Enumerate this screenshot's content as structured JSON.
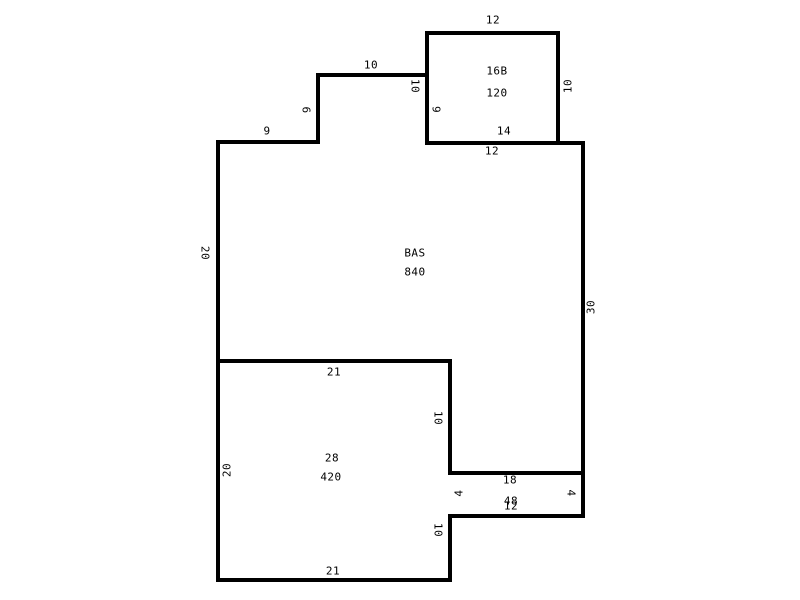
{
  "diagram": {
    "type": "floorplan-sketch",
    "background_color": "#ffffff",
    "wall_color": "#000000",
    "text_color": "#000000",
    "wall_thickness_px": 4,
    "rooms": [
      {
        "label": "16B",
        "area": "120",
        "dimensions": [
          "12",
          "10",
          "12",
          "10",
          "6"
        ]
      },
      {
        "label": "BAS",
        "area": "840",
        "dimensions": [
          "9",
          "6",
          "10",
          "14",
          "30",
          "20"
        ]
      },
      {
        "label": "28",
        "area": "420",
        "dimensions": [
          "21",
          "20",
          "10",
          "10",
          "21"
        ]
      },
      {
        "label": "18",
        "area": "48",
        "dimensions": [
          "4",
          "12",
          "4"
        ]
      }
    ],
    "walls": [
      {
        "name": "wall-16b-top",
        "o": "h",
        "x": 427,
        "y": 33,
        "len": 131
      },
      {
        "name": "wall-16b-left",
        "o": "v",
        "x": 427,
        "y": 33,
        "len": 110
      },
      {
        "name": "wall-16b-right",
        "o": "v",
        "x": 558,
        "y": 33,
        "len": 110
      },
      {
        "name": "wall-step-top",
        "o": "h",
        "x": 318,
        "y": 75,
        "len": 109
      },
      {
        "name": "wall-step-left",
        "o": "v",
        "x": 318,
        "y": 75,
        "len": 67
      },
      {
        "name": "wall-bas-top-left",
        "o": "h",
        "x": 218,
        "y": 142,
        "len": 100
      },
      {
        "name": "wall-bas-top-right",
        "o": "h",
        "x": 427,
        "y": 143,
        "len": 156
      },
      {
        "name": "wall-left-edge",
        "o": "v",
        "x": 218,
        "y": 142,
        "len": 438
      },
      {
        "name": "wall-right-edge",
        "o": "v",
        "x": 583,
        "y": 143,
        "len": 373
      },
      {
        "name": "wall-room28-top",
        "o": "h",
        "x": 218,
        "y": 361,
        "len": 232
      },
      {
        "name": "wall-room28-right-up",
        "o": "v",
        "x": 450,
        "y": 361,
        "len": 112
      },
      {
        "name": "wall-strip-top",
        "o": "h",
        "x": 450,
        "y": 473,
        "len": 133
      },
      {
        "name": "wall-strip-bottom",
        "o": "h",
        "x": 450,
        "y": 516,
        "len": 133
      },
      {
        "name": "wall-room28-right-low",
        "o": "v",
        "x": 450,
        "y": 516,
        "len": 64
      },
      {
        "name": "wall-room28-bottom",
        "o": "h",
        "x": 218,
        "y": 580,
        "len": 232
      }
    ],
    "texts": [
      {
        "name": "dim-16b-top",
        "t": "12",
        "x": 493,
        "y": 20,
        "r": 0
      },
      {
        "name": "room-16b-label",
        "t": "16B",
        "x": 497,
        "y": 71,
        "r": 0
      },
      {
        "name": "room-16b-area",
        "t": "120",
        "x": 497,
        "y": 93,
        "r": 0
      },
      {
        "name": "dim-16b-right",
        "t": "10",
        "x": 568,
        "y": 86,
        "r": -90
      },
      {
        "name": "dim-16b-left",
        "t": "10",
        "x": 415,
        "y": 86,
        "r": 90
      },
      {
        "name": "dim-16b-left-lower",
        "t": "6",
        "x": 437,
        "y": 109,
        "r": -90
      },
      {
        "name": "dim-bas-top-right-seg",
        "t": "14",
        "x": 504,
        "y": 131,
        "r": 0
      },
      {
        "name": "dim-16b-bottom",
        "t": "12",
        "x": 492,
        "y": 151,
        "r": 0
      },
      {
        "name": "dim-step-top",
        "t": "10",
        "x": 371,
        "y": 65,
        "r": 0
      },
      {
        "name": "dim-step-left",
        "t": "6",
        "x": 306,
        "y": 110,
        "r": 90
      },
      {
        "name": "dim-bas-top-left-seg",
        "t": "9",
        "x": 267,
        "y": 131,
        "r": 0
      },
      {
        "name": "dim-bas-left",
        "t": "20",
        "x": 205,
        "y": 253,
        "r": 90
      },
      {
        "name": "room-bas-label",
        "t": "BAS",
        "x": 415,
        "y": 253,
        "r": 0
      },
      {
        "name": "room-bas-area",
        "t": "840",
        "x": 415,
        "y": 272,
        "r": 0
      },
      {
        "name": "dim-bas-right",
        "t": "30",
        "x": 591,
        "y": 307,
        "r": -90
      },
      {
        "name": "dim-room28-top",
        "t": "21",
        "x": 334,
        "y": 372,
        "r": 0
      },
      {
        "name": "dim-room28-right-upper",
        "t": "10",
        "x": 438,
        "y": 418,
        "r": 90
      },
      {
        "name": "room-28-label",
        "t": "28",
        "x": 332,
        "y": 458,
        "r": 0
      },
      {
        "name": "dim-room28-left",
        "t": "20",
        "x": 227,
        "y": 470,
        "r": -90
      },
      {
        "name": "room-28-area",
        "t": "420",
        "x": 331,
        "y": 477,
        "r": 0
      },
      {
        "name": "room-18-label",
        "t": "18",
        "x": 510,
        "y": 480,
        "r": 0
      },
      {
        "name": "dim-strip-left",
        "t": "4",
        "x": 459,
        "y": 493,
        "r": -90
      },
      {
        "name": "dim-strip-right",
        "t": "4",
        "x": 571,
        "y": 493,
        "r": 90
      },
      {
        "name": "room-18-area",
        "t": "48",
        "x": 511,
        "y": 501,
        "r": 0
      },
      {
        "name": "dim-strip-bottom",
        "t": "12",
        "x": 511,
        "y": 506,
        "r": 0
      },
      {
        "name": "dim-room28-right-lower",
        "t": "10",
        "x": 438,
        "y": 530,
        "r": 90
      },
      {
        "name": "dim-room28-bottom",
        "t": "21",
        "x": 333,
        "y": 571,
        "r": 0
      }
    ]
  }
}
